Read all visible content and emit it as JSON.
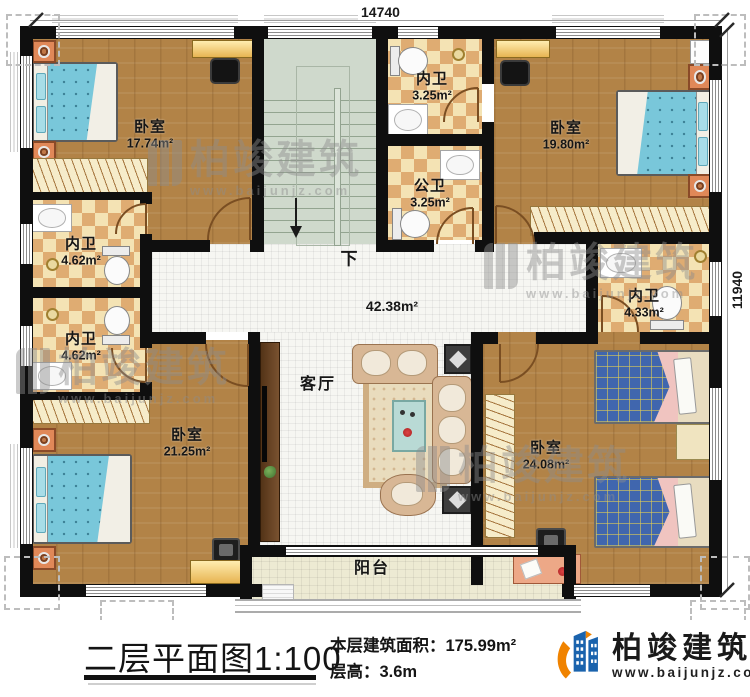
{
  "plan": {
    "dim_top": "14740",
    "dim_right": "11940",
    "stairs_down": "下",
    "rooms": [
      {
        "id": "bedroom-top-left",
        "name": "卧室",
        "area": "17.74m²"
      },
      {
        "id": "ensuite-left-upper",
        "name": "内卫",
        "area": "4.62m²"
      },
      {
        "id": "ensuite-left-lower",
        "name": "内卫",
        "area": "4.62m²"
      },
      {
        "id": "bedroom-bottom-left",
        "name": "卧室",
        "area": "21.25m²"
      },
      {
        "id": "ensuite-top",
        "name": "内卫",
        "area": "3.25m²"
      },
      {
        "id": "public-bath",
        "name": "公卫",
        "area": "3.25m²"
      },
      {
        "id": "bedroom-top-right",
        "name": "卧室",
        "area": "19.80m²"
      },
      {
        "id": "ensuite-right",
        "name": "内卫",
        "area": "4.33m²"
      },
      {
        "id": "living-room",
        "name": "客厅",
        "area": "42.38m²"
      },
      {
        "id": "bedroom-bottom-right",
        "name": "卧室",
        "area": "24.08m²"
      },
      {
        "id": "balcony",
        "name": "阳台"
      }
    ]
  },
  "watermark": {
    "name": "柏竣建筑",
    "url": "www.baijunjz.com"
  },
  "footer": {
    "title": "二层平面图",
    "scale": "1:100",
    "area_label": "本层建筑面积：",
    "area_value": "175.99m²",
    "height_label": "层高：",
    "height_value": "3.6m"
  },
  "logo": {
    "name": "柏竣建筑",
    "url": "www.baijunjz.com"
  }
}
